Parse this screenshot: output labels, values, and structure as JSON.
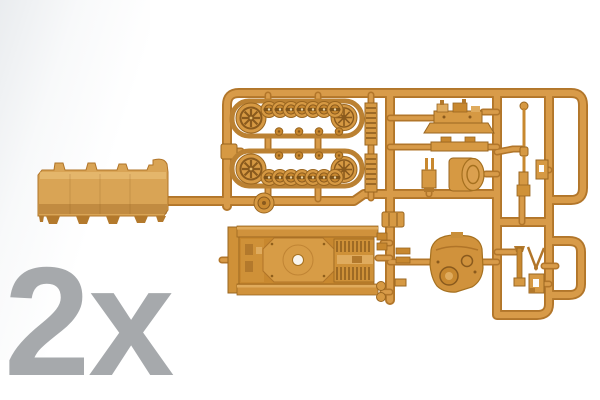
{
  "label": {
    "quantity": "2x"
  },
  "description": "Product photo: tan plastic model-kit sprue with snap-fit tank parts - two track assemblies with road wheels and sprockets, hull side panel, hull top deck with turret ring, round turret, superstructure, gun barrel and small fittings. Gray quantity marking 2x at lower left.",
  "colors": {
    "background": "#ffffff",
    "label_gray": "#a6a9ac",
    "rail_edge": "#b2762a",
    "rail_face": "#d89b49",
    "plastic": "#d69943",
    "plastic_dark": "#9a6620",
    "plastic_deep": "#8a5a1d",
    "plastic_light": "#e5b868",
    "hull_slab": "#d9a455",
    "hole_white": "#f8f5ef"
  },
  "parts_visible": [
    "sprue frame",
    "upper track assembly",
    "lower track assembly",
    "drive sprockets and idler wheels",
    "road wheels",
    "hull side panel",
    "hull top deck",
    "turret",
    "superstructure",
    "gun barrel",
    "tool and fitting parts"
  ]
}
